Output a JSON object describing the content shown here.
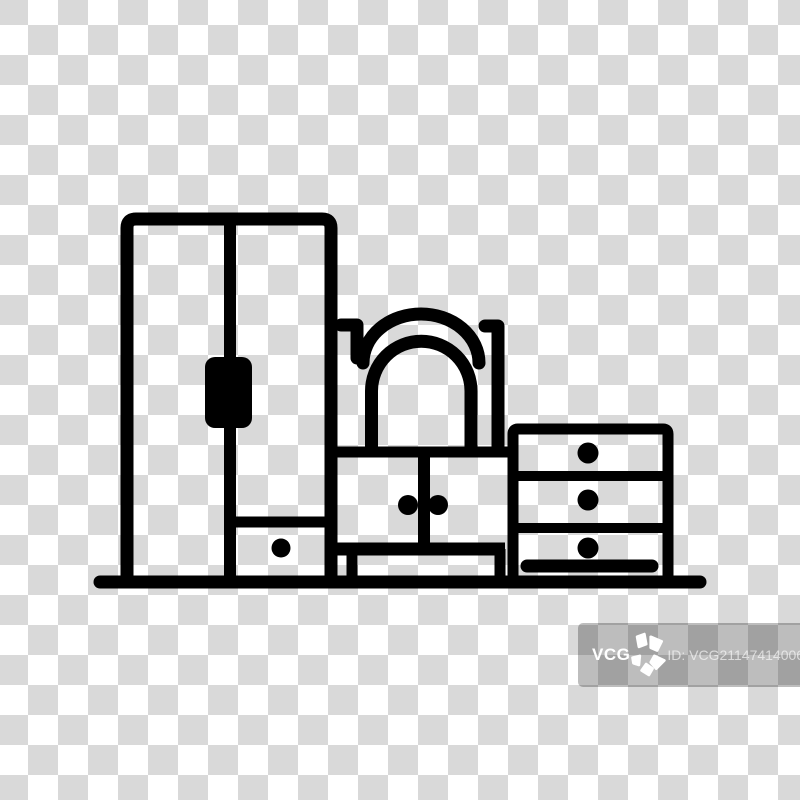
{
  "image": {
    "description": "Bedroom furniture line icon on a transparent checkerboard background",
    "icon_parts": [
      "wardrobe",
      "dressing-table-with-arched-mirror",
      "chest-of-drawers",
      "floor-line"
    ]
  },
  "colors": {
    "icon": "#000000",
    "checker_white": "#ffffff",
    "checker_gray": "#d9d9d9",
    "watermark_overlay": "rgba(0,0,0,0.26)",
    "watermark_text": "#ffffff",
    "watermark_id_text": "rgba(255,255,255,0.62)"
  },
  "watermark": {
    "brand": "VCG",
    "logo_icon": "pinwheel-flower-icon",
    "id_label": "ID: VCG211474140066"
  }
}
